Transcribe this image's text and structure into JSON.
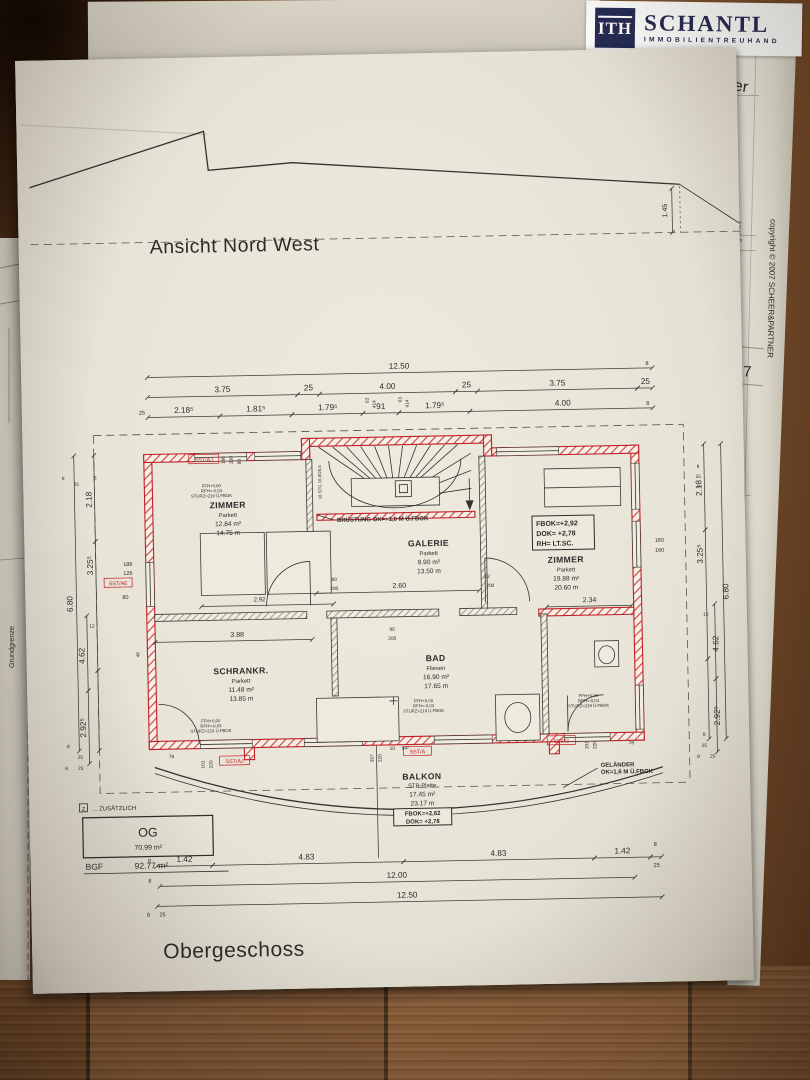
{
  "logo": {
    "mark": "ITH",
    "name": "SCHANTL",
    "subtitle": "IMMOBILIENTREUHAND",
    "navy": "#262b54"
  },
  "underlay": {
    "fragment": "er",
    "copyright": "copyright © 2007 SCHEER&PARTNER",
    "page_number": "7"
  },
  "titles": {
    "elevation": "Ansicht Nord West",
    "floor": "Obergeschoss"
  },
  "boundary": {
    "left": "Grundgrenze",
    "right": "Grundgrenze"
  },
  "rooms": {
    "zimmer_nw": {
      "name": "ZIMMER",
      "finish": "Parkett",
      "area": "12.84 m²",
      "perim": "14.75 m"
    },
    "galerie": {
      "name": "GALERIE",
      "finish": "Parkett",
      "area": "9.90 m²",
      "perim": "13.50 m"
    },
    "zimmer_ne": {
      "name": "ZIMMER",
      "finish": "Parkett",
      "area": "19.88 m²",
      "perim": "20.60 m"
    },
    "schrankr": {
      "name": "SCHRANKR.",
      "finish": "Parkett",
      "area": "11.48 m²",
      "perim": "13.85 m"
    },
    "bad": {
      "name": "BAD",
      "finish": "Fliesen",
      "area": "16.90 m²",
      "perim": "17.65 m"
    },
    "balkon": {
      "name": "BALKON",
      "finish": "STB-Platte",
      "area": "17.45 m²",
      "perim": "23.17 m"
    }
  },
  "level_box": {
    "l1": "FBOK=+2,92",
    "l2": "DOK= +2,78",
    "l3": "RH=  LT.SC."
  },
  "balkon_box": {
    "l1": "FBOK=+2,62",
    "l2": "DOK= +2,78"
  },
  "notes": {
    "bruestung": "BRÜSTUNG OK=+1,0 M Ü.FBOK",
    "gelaender1": "GELÄNDER",
    "gelaender2": "OK=1,6 M Ü.FBOK",
    "stair": "18 STG 16,8/26,5",
    "small1": "FFH+0,00",
    "small2": "RFH=-0,03",
    "small3": "STURZ=219 Ü.FBOK"
  },
  "summary": {
    "mark": "Z",
    "header": "... ZUSÄTZLICH",
    "level": "OG",
    "area": "70.99 m²",
    "bgf_label": "BGF",
    "bgf_value": "92.77 m²"
  },
  "tags": {
    "t1": "SST/AJ",
    "t2": "SST/AE",
    "t3": "SST/AJ",
    "t4": "SST/A",
    "t5": "SST/G"
  },
  "dims": {
    "v1250": "12.50",
    "v1200": "12.00",
    "v375": "3.75",
    "v400": "4.00",
    "v25": "25",
    "v8": "8",
    "v218s": "2.18⁵",
    "v181s": "1.81⁵",
    "v179s": "1.79⁵",
    "v91": "91",
    "v63": "63",
    "v414": "414",
    "v142": "1.42",
    "v483": "4.83",
    "v680": "6.80",
    "v218": "2.18",
    "v325s": "3.25⁵",
    "v12": "12",
    "v462": "4.62",
    "v292s": "2.92⁵",
    "v292": "2.92",
    "v186": "186",
    "v126": "126",
    "v220": "220",
    "v80": "80",
    "v46": "46",
    "v160": "160",
    "v388": "3.88",
    "v260": "2.60",
    "v234": "2.34",
    "v200": "200",
    "v90": "90",
    "v101": "101",
    "v78": "78",
    "v397": "397",
    "v10": "10",
    "v94s": "94⁵",
    "v145": "1.45"
  }
}
